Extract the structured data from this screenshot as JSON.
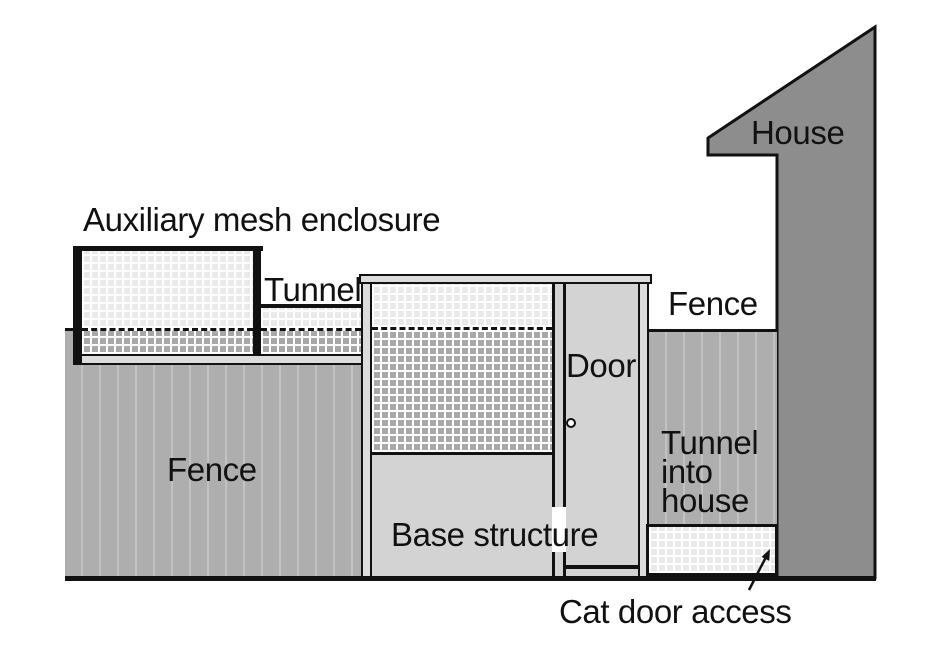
{
  "labels": {
    "house": "House",
    "auxiliary_enclosure": "Auxiliary mesh enclosure",
    "tunnel": "Tunnel",
    "fence_left": "Fence",
    "fence_right": "Fence",
    "door": "Door",
    "base_structure": "Base structure",
    "tunnel_into_house": [
      "Tunnel",
      "into",
      "house"
    ],
    "cat_door_access": "Cat door access"
  },
  "colors": {
    "ink": "#111111",
    "fence": "#aeaeae",
    "fence_line": "#c2c2c2",
    "house": "#8d8d8d",
    "panel": "#d3d3d3",
    "cap": "#dcdcdc",
    "mesh_light": "#e9e9e9",
    "mesh_dark": "#a8a8a8"
  }
}
